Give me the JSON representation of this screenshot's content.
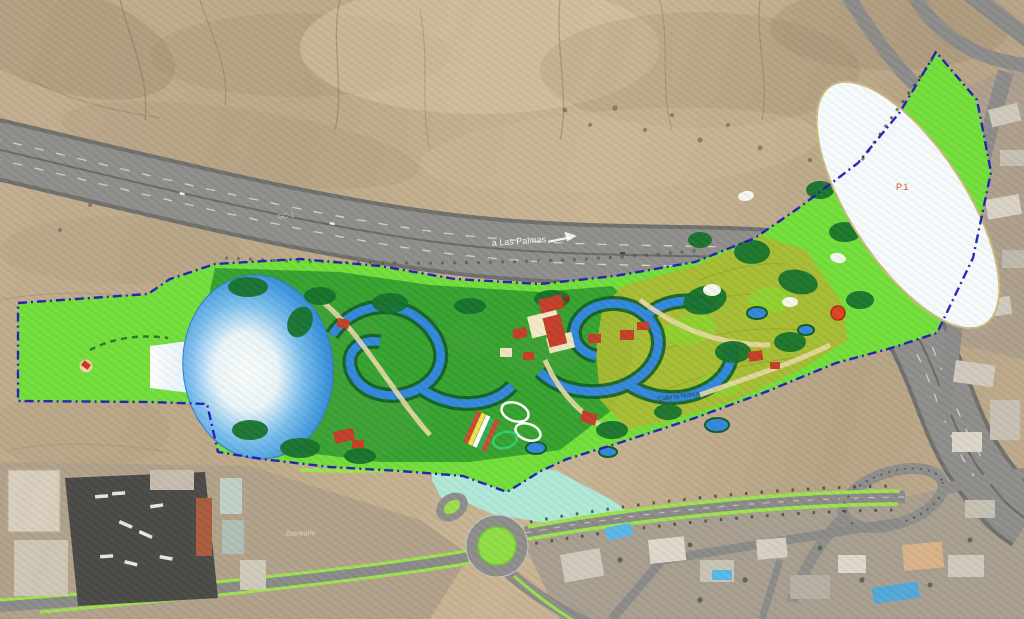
{
  "map": {
    "labels": {
      "highway_destination": "a Las Palmas",
      "road_code": "GC-1",
      "parking_area": "P.1",
      "place_ground": "Balneario",
      "street": "Calle la Marea"
    },
    "colors": {
      "boundary_blue": "#1b17b5",
      "park_green": "#70df38",
      "park_mid_green": "#2f9e2c",
      "park_dark_green": "#14702a",
      "park_olive": "#a9ba30",
      "water_blue": "#2f86dd",
      "sand_tan": "#e8d9a4",
      "roof_red": "#c23d28",
      "plaza_aqua": "#aeead9",
      "median_green": "#9ce34f",
      "asphalt_gray": "#8d8d8b",
      "parking_white": "#f6fbfd"
    }
  }
}
